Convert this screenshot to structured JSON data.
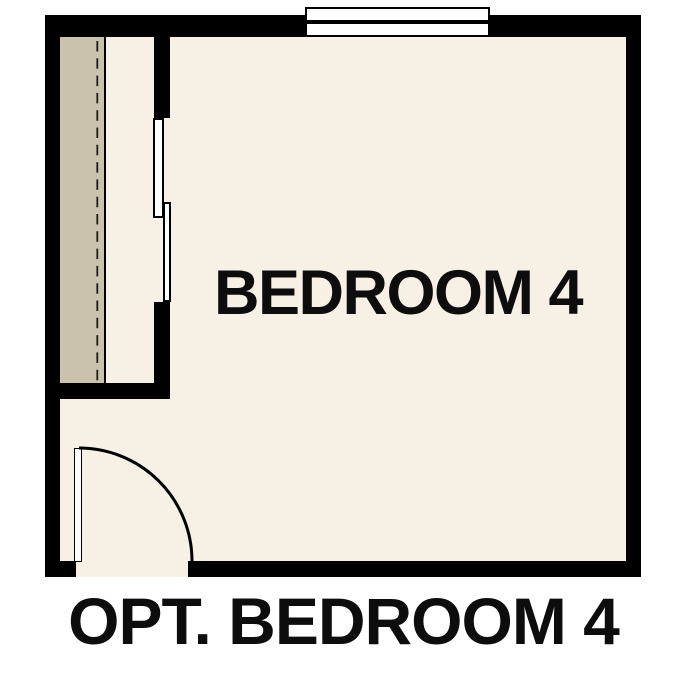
{
  "floorplan": {
    "room_label": "BEDROOM 4",
    "caption": "OPT. BEDROOM 4",
    "colors": {
      "wall": "#000000",
      "floor": "#f7f0e5",
      "closet_floor": "#cbc2ad",
      "window_fill": "#ffffff",
      "label_text": "#0d0d0d",
      "background": "#ffffff"
    }
  }
}
